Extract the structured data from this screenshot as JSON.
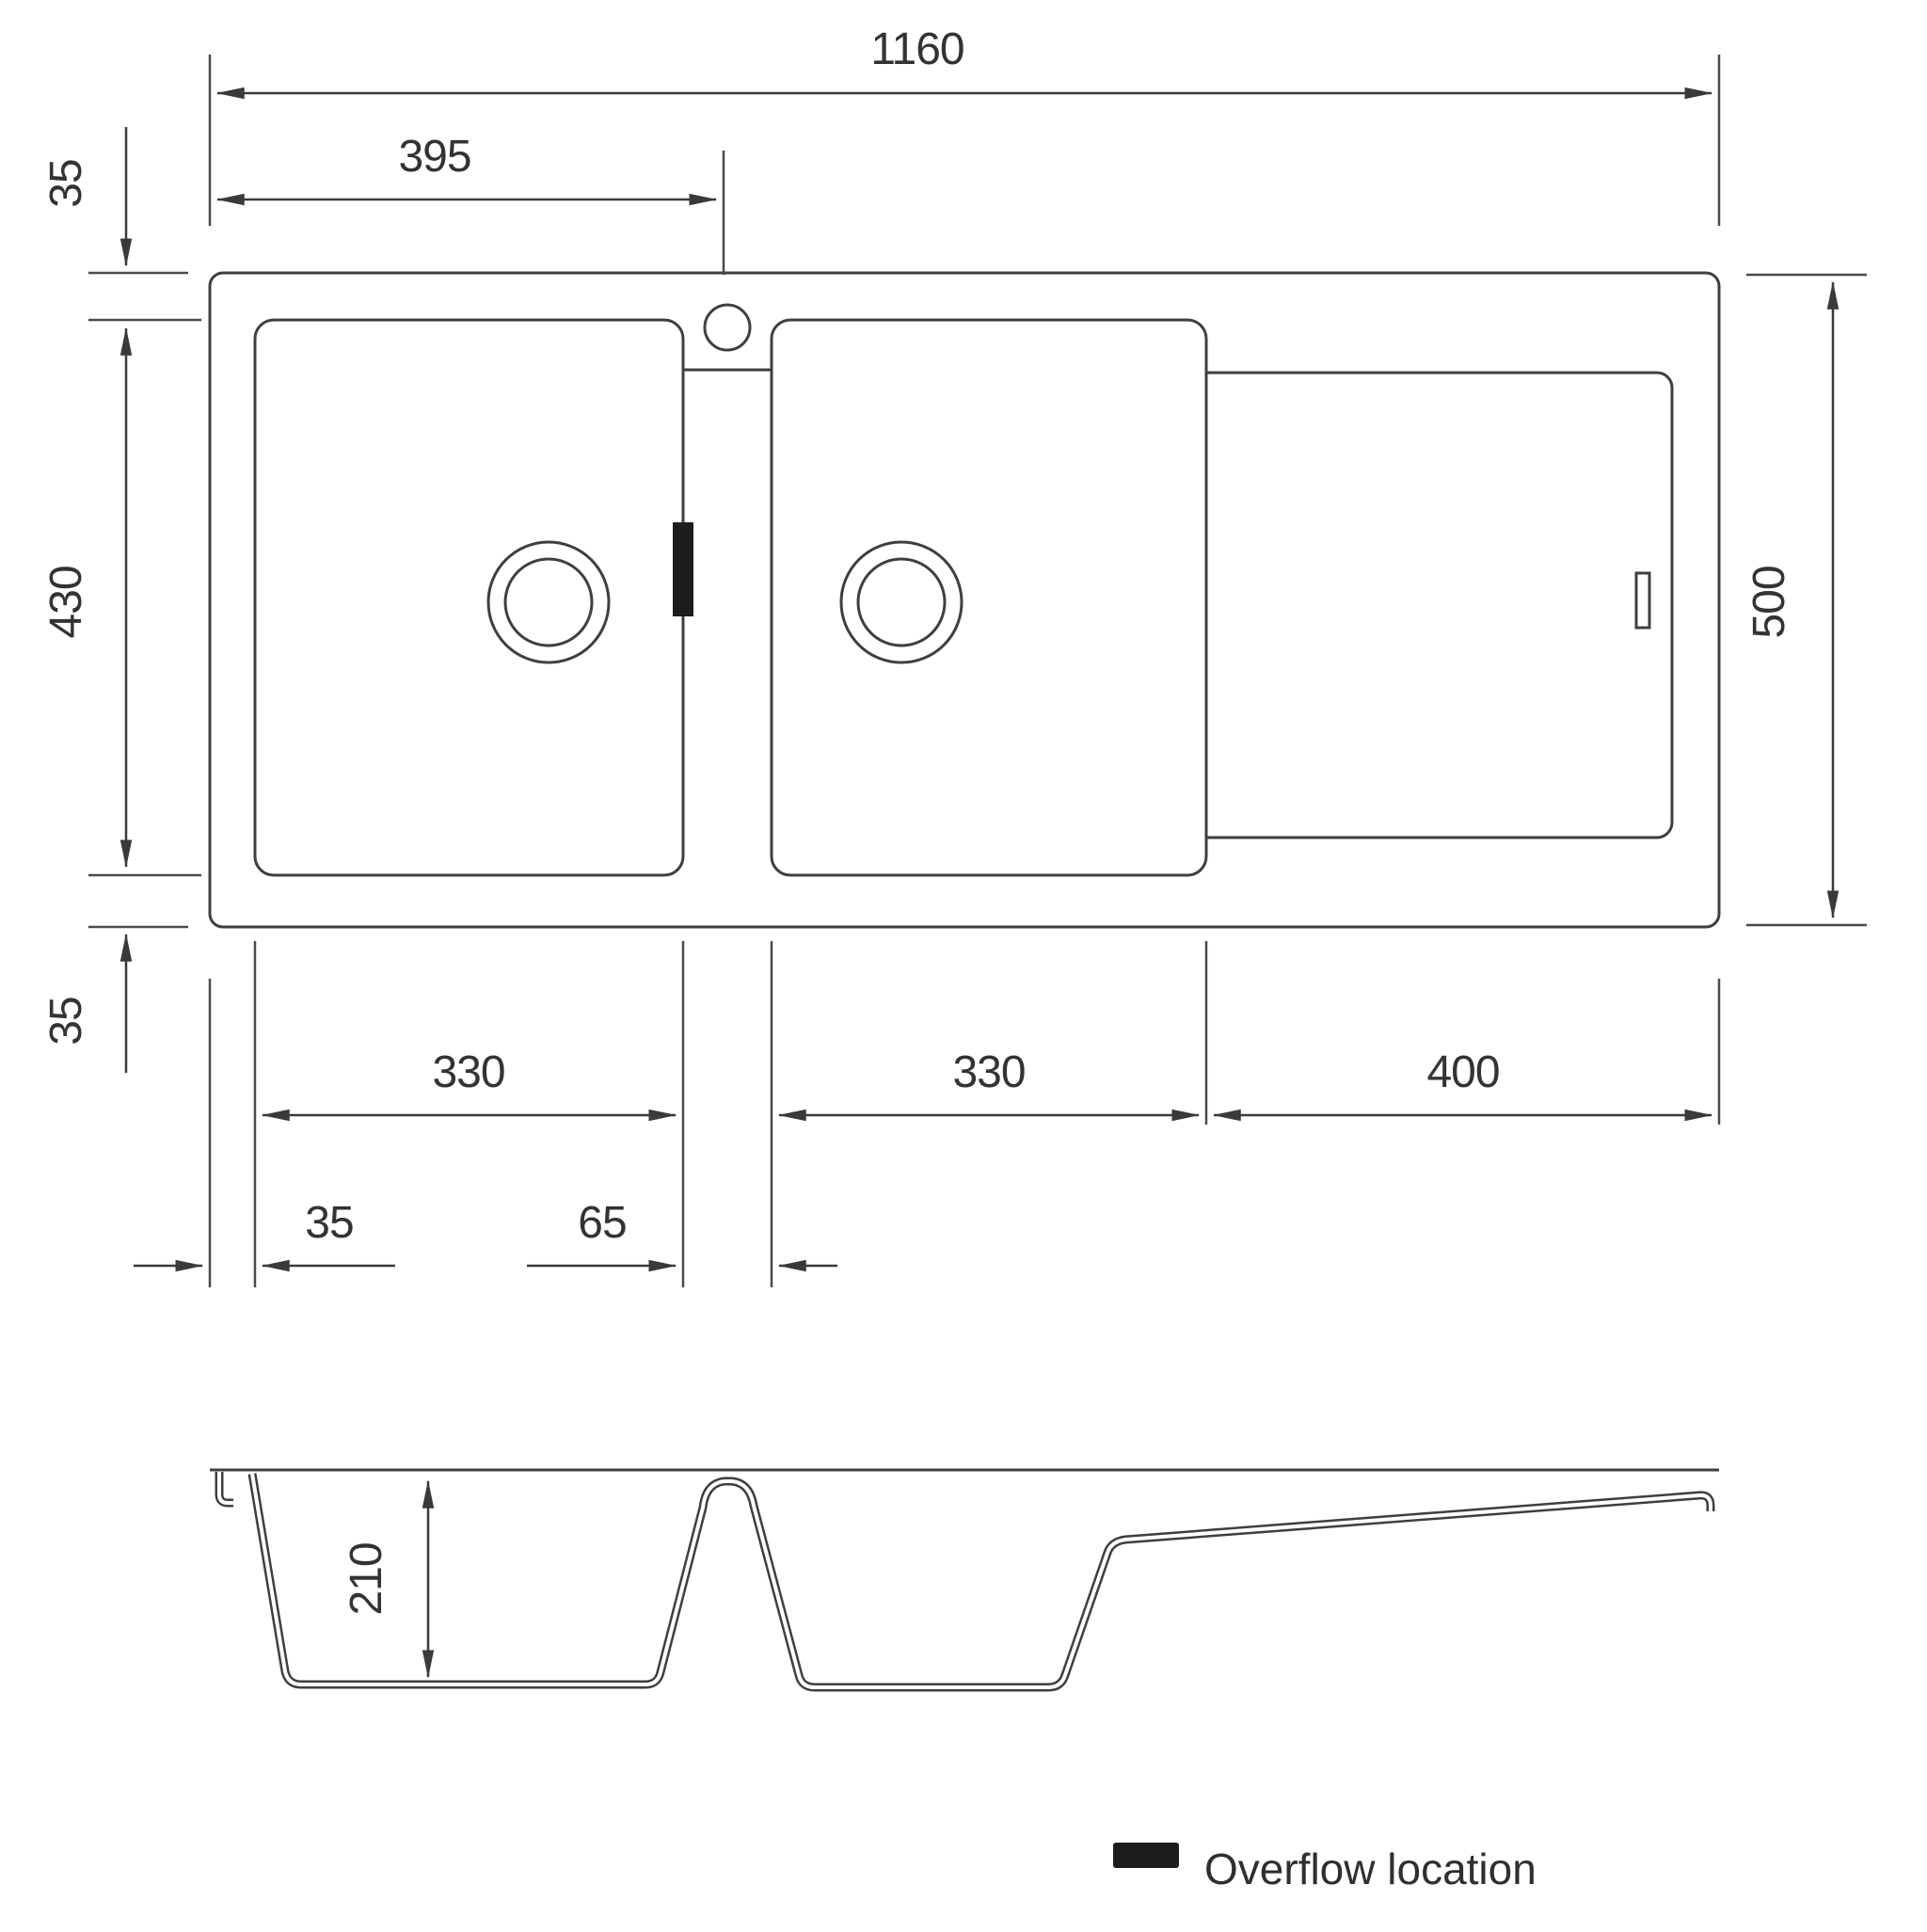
{
  "plan": {
    "dim_overall_width": "1160",
    "dim_tap_center": "395",
    "dim_rim_top": "35",
    "dim_bowl_length": "430",
    "dim_rim_bottom": "35",
    "dim_overall_depth": "500",
    "dim_bowl1_width": "330",
    "dim_bowl2_width": "330",
    "dim_drainer_width": "400",
    "dim_rim_left": "35",
    "dim_divider_width": "65"
  },
  "section": {
    "dim_bowl_depth": "210"
  },
  "legend": {
    "label": "Overflow location",
    "swatch_color": "#1c1c1c"
  },
  "colors": {
    "line": "#3f3f3f",
    "text": "#333333"
  }
}
